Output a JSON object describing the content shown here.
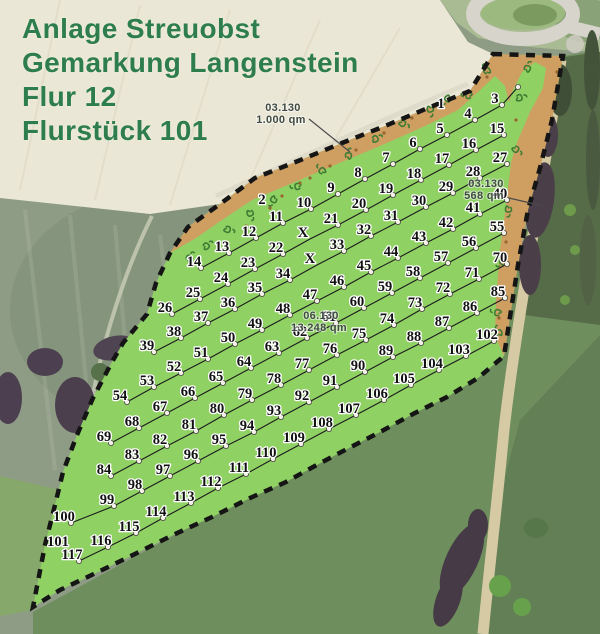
{
  "title": {
    "line1": "Anlage Streuobst",
    "line2": "Gemarkung Langenstein",
    "line3": "Flur 12",
    "line4": "Flurstück 101"
  },
  "colors": {
    "title_green": "#2e7d4c",
    "parcel_green": "#90d164",
    "hedge_orange": "#cf9f62",
    "boundary_black": "#151515",
    "tree_number": "#111111",
    "number_halo": "#ffffff",
    "area_label": "#3f4b42"
  },
  "area_labels": [
    {
      "code": "03.130",
      "area": "1.000 qm",
      "x": 283,
      "y": 114,
      "leader": [
        309,
        119,
        350,
        152
      ]
    },
    {
      "code": "03.130",
      "area": "568 qm",
      "x": 486,
      "y": 190,
      "leader": [
        509,
        198,
        543,
        206
      ]
    },
    {
      "code": "06.130",
      "area": "13.248 qm",
      "x": 321,
      "y": 322,
      "leader": null
    }
  ],
  "trees": [
    [
      "1",
      441,
      104,
      "strip"
    ],
    [
      "2",
      262,
      200,
      "strip"
    ],
    [
      "",
      511,
      81,
      "end"
    ],
    [
      "3",
      495,
      99
    ],
    [
      "4",
      468,
      114
    ],
    [
      "5",
      440,
      129
    ],
    [
      "6",
      413,
      143
    ],
    [
      "7",
      386,
      158
    ],
    [
      "8",
      358,
      173
    ],
    [
      "9",
      331,
      188
    ],
    [
      "10",
      304,
      203
    ],
    [
      "11",
      276,
      217
    ],
    [
      "12",
      249,
      232
    ],
    [
      "13",
      222,
      247
    ],
    [
      "14",
      194,
      262
    ],
    [
      "15",
      497,
      129
    ],
    [
      "16",
      469,
      144
    ],
    [
      "17",
      442,
      159
    ],
    [
      "18",
      414,
      174
    ],
    [
      "19",
      386,
      189
    ],
    [
      "20",
      359,
      204
    ],
    [
      "21",
      331,
      219
    ],
    [
      "X",
      303,
      233,
      "x"
    ],
    [
      "22",
      276,
      248
    ],
    [
      "23",
      248,
      263
    ],
    [
      "24",
      221,
      278
    ],
    [
      "25",
      193,
      293
    ],
    [
      "26",
      165,
      308
    ],
    [
      "27",
      500,
      158
    ],
    [
      "28",
      473,
      172
    ],
    [
      "29",
      446,
      187
    ],
    [
      "30",
      419,
      201
    ],
    [
      "31",
      391,
      216
    ],
    [
      "32",
      364,
      230
    ],
    [
      "33",
      337,
      245
    ],
    [
      "X",
      310,
      259,
      "x"
    ],
    [
      "34",
      283,
      274
    ],
    [
      "35",
      255,
      288
    ],
    [
      "36",
      228,
      303
    ],
    [
      "37",
      201,
      317
    ],
    [
      "38",
      174,
      332
    ],
    [
      "39",
      147,
      346
    ],
    [
      "40",
      500,
      194
    ],
    [
      "41",
      473,
      208
    ],
    [
      "42",
      446,
      223
    ],
    [
      "43",
      419,
      237
    ],
    [
      "44",
      391,
      252
    ],
    [
      "45",
      364,
      266
    ],
    [
      "46",
      337,
      281
    ],
    [
      "47",
      310,
      295
    ],
    [
      "48",
      283,
      309
    ],
    [
      "49",
      255,
      324
    ],
    [
      "50",
      228,
      338
    ],
    [
      "51",
      201,
      353
    ],
    [
      "52",
      174,
      367
    ],
    [
      "53",
      147,
      381
    ],
    [
      "54",
      120,
      396
    ],
    [
      "55",
      497,
      227
    ],
    [
      "56",
      469,
      242
    ],
    [
      "57",
      441,
      257
    ],
    [
      "58",
      413,
      272
    ],
    [
      "59",
      385,
      287
    ],
    [
      "60",
      357,
      302
    ],
    [
      "61",
      329,
      317
    ],
    [
      "62",
      300,
      332
    ],
    [
      "63",
      272,
      347
    ],
    [
      "64",
      244,
      362
    ],
    [
      "65",
      216,
      377
    ],
    [
      "66",
      188,
      392
    ],
    [
      "67",
      160,
      407
    ],
    [
      "68",
      132,
      422
    ],
    [
      "69",
      104,
      437
    ],
    [
      "70",
      500,
      258
    ],
    [
      "71",
      472,
      273
    ],
    [
      "72",
      443,
      288
    ],
    [
      "73",
      415,
      303
    ],
    [
      "74",
      387,
      319
    ],
    [
      "75",
      359,
      334
    ],
    [
      "76",
      330,
      349
    ],
    [
      "77",
      302,
      364
    ],
    [
      "78",
      274,
      379
    ],
    [
      "79",
      245,
      394
    ],
    [
      "80",
      217,
      409
    ],
    [
      "81",
      189,
      425
    ],
    [
      "82",
      160,
      440
    ],
    [
      "83",
      132,
      455
    ],
    [
      "84",
      104,
      470
    ],
    [
      "85",
      498,
      292
    ],
    [
      "86",
      470,
      307
    ],
    [
      "87",
      442,
      322
    ],
    [
      "88",
      414,
      337
    ],
    [
      "89",
      386,
      351
    ],
    [
      "90",
      358,
      366
    ],
    [
      "91",
      330,
      381
    ],
    [
      "92",
      302,
      396
    ],
    [
      "93",
      274,
      411
    ],
    [
      "94",
      247,
      426
    ],
    [
      "95",
      219,
      440
    ],
    [
      "96",
      191,
      455
    ],
    [
      "97",
      163,
      470
    ],
    [
      "98",
      135,
      485
    ],
    [
      "99",
      107,
      500
    ],
    [
      "100",
      64,
      517
    ],
    [
      "102",
      487,
      335
    ],
    [
      "103",
      459,
      350
    ],
    [
      "104",
      432,
      364
    ],
    [
      "105",
      404,
      379
    ],
    [
      "106",
      377,
      394
    ],
    [
      "107",
      349,
      409
    ],
    [
      "108",
      322,
      423
    ],
    [
      "109",
      294,
      438
    ],
    [
      "110",
      266,
      453
    ],
    [
      "111",
      239,
      468
    ],
    [
      "112",
      211,
      482
    ],
    [
      "113",
      184,
      497
    ],
    [
      "114",
      156,
      512
    ],
    [
      "115",
      129,
      527
    ],
    [
      "116",
      101,
      541
    ],
    [
      "117",
      72,
      555
    ],
    [
      "101",
      58,
      542,
      "plot"
    ]
  ],
  "rows": [
    [
      2,
      14
    ],
    [
      15,
      27
    ],
    [
      28,
      41
    ],
    [
      42,
      56
    ],
    [
      57,
      71
    ],
    [
      72,
      86
    ],
    [
      87,
      102
    ],
    [
      103,
      118
    ]
  ]
}
